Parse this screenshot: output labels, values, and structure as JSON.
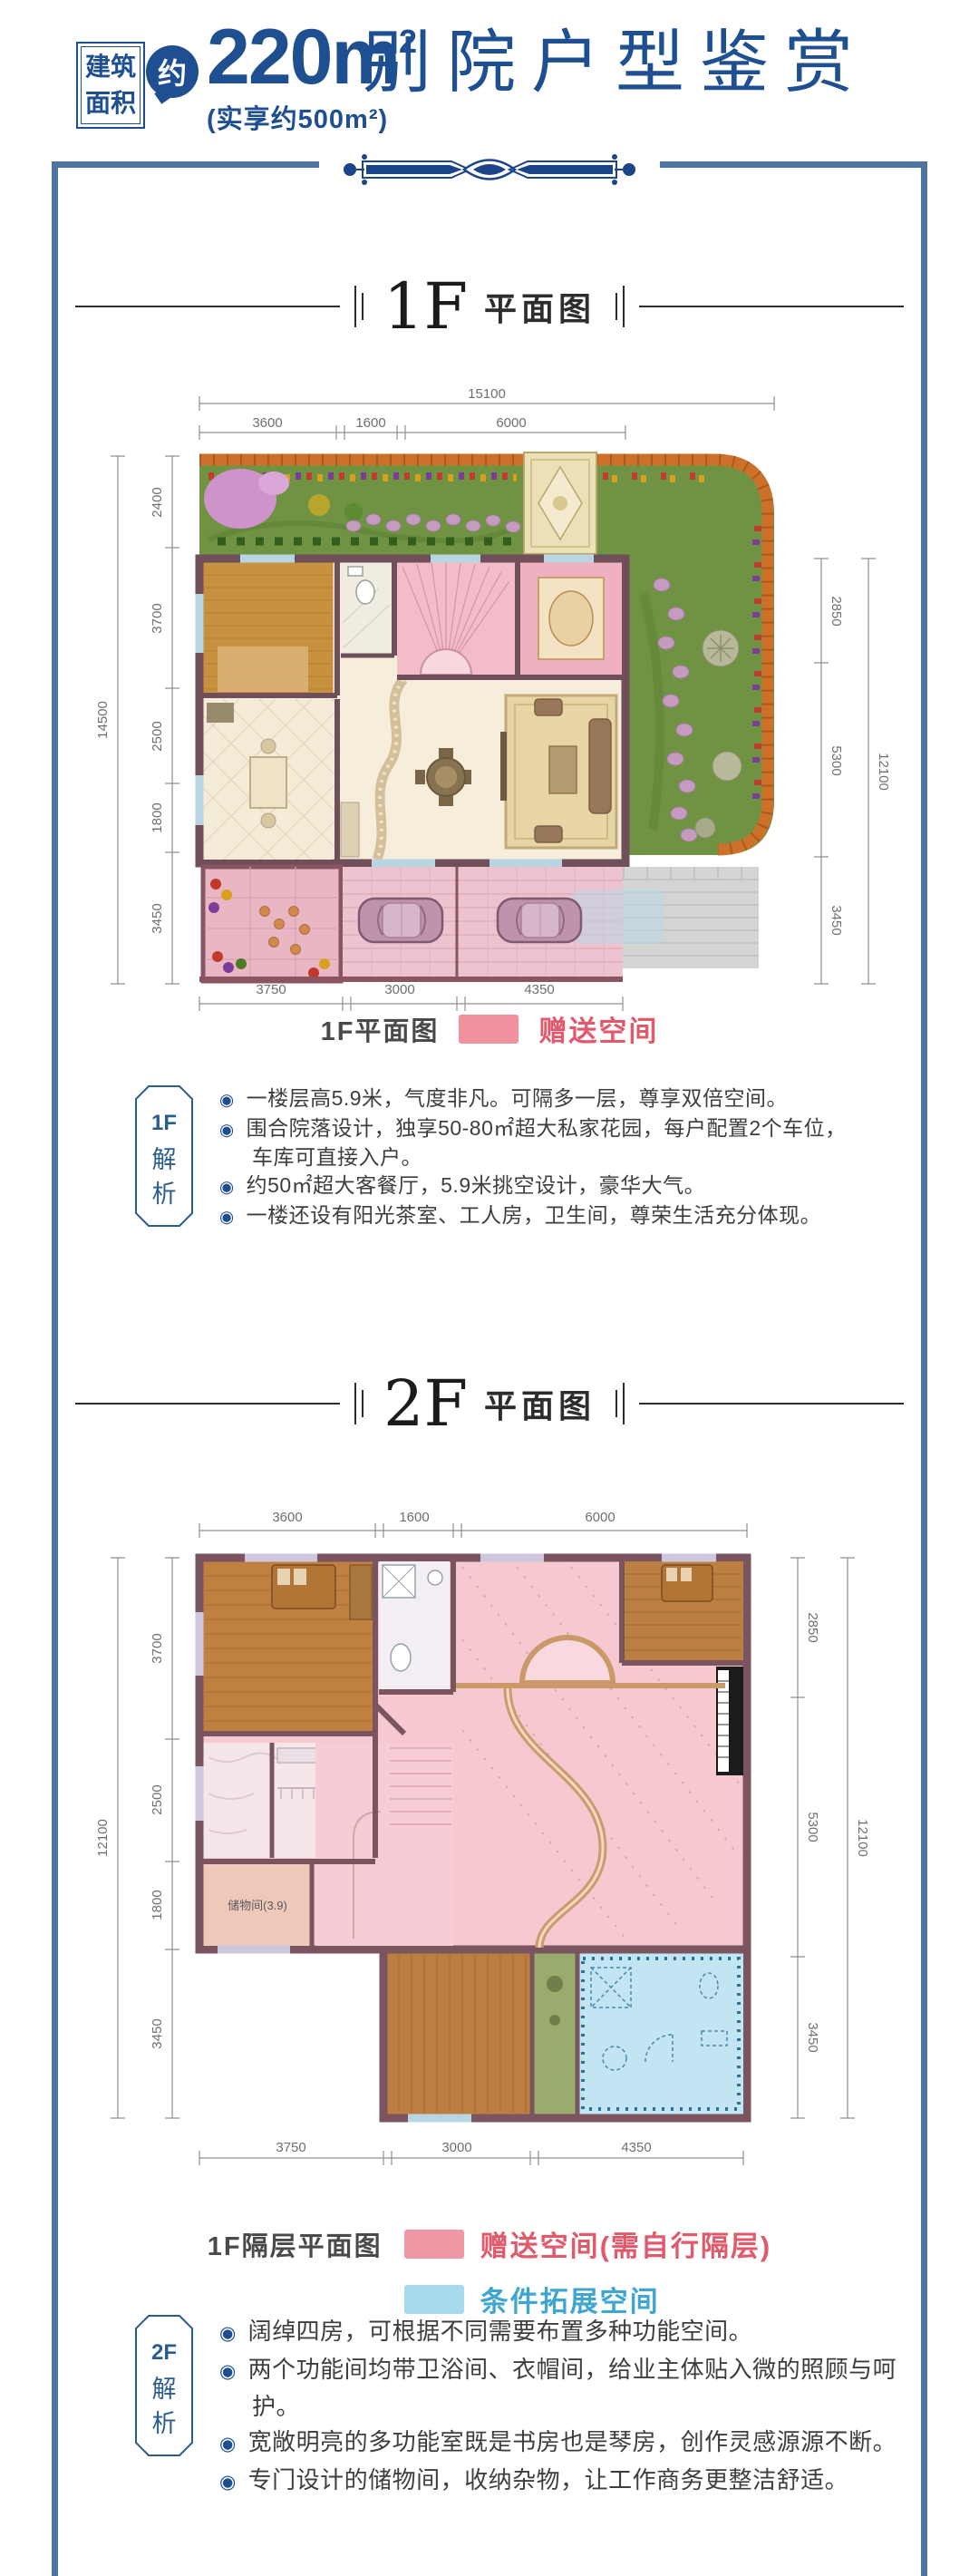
{
  "page": {
    "accent_blue": "#1e4f91",
    "frame_color": "#4e74a1",
    "ornament_color": "#1b4489"
  },
  "header": {
    "badge": [
      "建筑",
      "面积"
    ],
    "approx": "约",
    "area_value": "220m",
    "area_sup": "2",
    "actual_area": "(实享约500m²)",
    "title": "别院户型鉴赏"
  },
  "f1": {
    "heading": {
      "floor": "1F",
      "suffix": "平面图"
    },
    "dims": {
      "top_overall": "15100",
      "top": [
        "3600",
        "1600",
        "6000"
      ],
      "left": [
        "2400",
        "3700",
        "2500",
        "1800",
        "3450"
      ],
      "left_overall": "14500",
      "right": [
        "2850",
        "5300",
        "3450"
      ],
      "right_overall": "12100",
      "bottom": [
        "3750",
        "3000",
        "4350"
      ]
    },
    "legend": {
      "label": "1F平面图",
      "gift": {
        "label": "赠送空间",
        "swatch": "#f2919e",
        "text_color": "#e05a6c"
      }
    },
    "analysis": {
      "tag": [
        "1F",
        "解",
        "析"
      ],
      "bullets": [
        "一楼层高5.9米，气度非凡。可隔多一层，尊享双倍空间。",
        "围合院落设计，独享50-80㎡超大私家花园，每户配置2个车位，车库可直接入户。",
        "约50㎡超大客餐厅，5.9米挑空设计，豪华大气。",
        "一楼还设有阳光茶室、工人房，卫生间，尊荣生活充分体现。"
      ]
    }
  },
  "f2": {
    "heading": {
      "floor": "2F",
      "suffix": "平面图"
    },
    "dims": {
      "top": [
        "3600",
        "1600",
        "6000"
      ],
      "left": [
        "3700",
        "2500",
        "1800",
        "3450"
      ],
      "left_overall": "12100",
      "right": [
        "2850",
        "5300",
        "3450"
      ],
      "right_overall": "12100",
      "bottom": [
        "3750",
        "3000",
        "4350"
      ]
    },
    "room_label": "储物间(3.9)",
    "legend": {
      "label": "1F隔层平面图",
      "gift": {
        "label": "赠送空间(需自行隔层)",
        "swatch": "#ef97a4",
        "text_color": "#e05a6c"
      },
      "expand": {
        "label": "条件拓展空间",
        "swatch": "#a6d9ee",
        "text_color": "#3fa7cf"
      }
    },
    "analysis": {
      "tag": [
        "2F",
        "解",
        "析"
      ],
      "bullets": [
        "阔绰四房，可根据不同需要布置多种功能空间。",
        "两个功能间均带卫浴间、衣帽间，给业主体贴入微的照顾与呵护。",
        "宽敞明亮的多功能室既是书房也是琴房，创作灵感源源不断。",
        "专门设计的储物间，收纳杂物，让工作商务更整洁舒适。"
      ]
    }
  }
}
